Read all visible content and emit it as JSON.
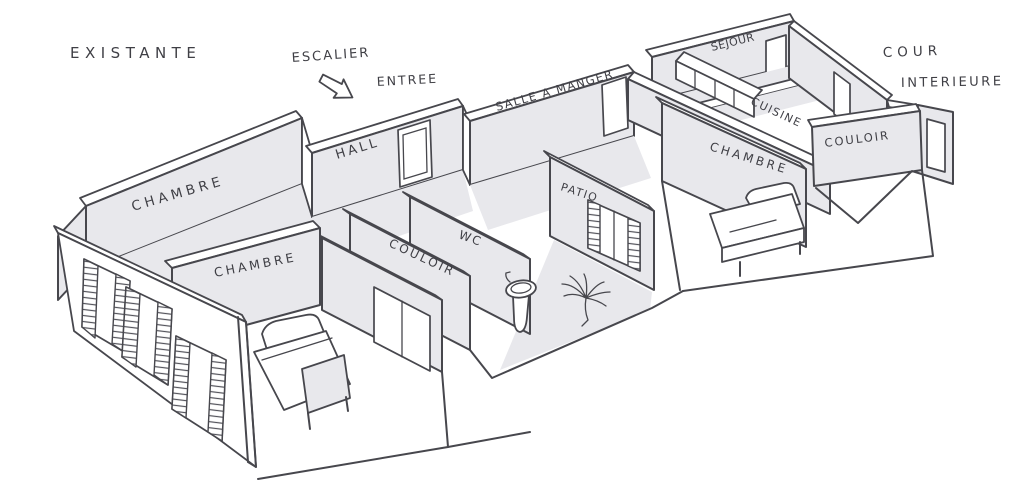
{
  "scene": {
    "kind": "hand-drawn axonometric floor plan sketch",
    "colors": {
      "paper": "#ffffff",
      "ink": "#47474d",
      "wall_fill": "#e8e8ec"
    },
    "entry_arrow_icon": "entry-direction-arrow"
  },
  "rooms_visible": [
    "CHAMBRE",
    "CHAMBRE",
    "CHAMBRE",
    "HALL",
    "SALLE A MANGER",
    "SEJOUR",
    "CUISINE",
    "COULOIR",
    "COULOIR",
    "WC",
    "PATIO"
  ],
  "annotations_visible": [
    "EXISTANTE",
    "ESCALIER",
    "ENTREE",
    "COUR INTERIEURE"
  ],
  "labels": [
    {
      "id": "existante-note",
      "text": "EXISTANTE",
      "x": 70,
      "y": 58,
      "rot": 0,
      "size": 15,
      "ls": 5.5
    },
    {
      "id": "escalier-note",
      "text": "ESCALIER",
      "x": 292,
      "y": 62,
      "rot": -4,
      "size": 13,
      "ls": 2
    },
    {
      "id": "entree-note",
      "text": "ENTREE",
      "x": 377,
      "y": 86,
      "rot": -3,
      "size": 12.5,
      "ls": 2
    },
    {
      "id": "salle-a-manger",
      "text": "SALLE A MANGER",
      "x": 497,
      "y": 111,
      "rot": -16,
      "size": 11.5,
      "ls": 1.5
    },
    {
      "id": "sejour",
      "text": "SEJOUR",
      "x": 712,
      "y": 51,
      "rot": -14,
      "size": 11,
      "ls": 0.5
    },
    {
      "id": "cour-note",
      "text": "COUR",
      "x": 883,
      "y": 57,
      "rot": -2,
      "size": 13.5,
      "ls": 5
    },
    {
      "id": "interieure-note",
      "text": "INTERIEURE",
      "x": 901,
      "y": 87,
      "rot": -1,
      "size": 13,
      "ls": 2.5
    },
    {
      "id": "cuisine",
      "text": "CUISINE",
      "x": 750,
      "y": 104,
      "rot": 25,
      "size": 11,
      "ls": 1.5
    },
    {
      "id": "hall",
      "text": "HALL",
      "x": 337,
      "y": 159,
      "rot": -17,
      "size": 13,
      "ls": 3
    },
    {
      "id": "chambre-back-left",
      "text": "CHAMBRE",
      "x": 133,
      "y": 211,
      "rot": -16,
      "size": 13.5,
      "ls": 4
    },
    {
      "id": "chambre-left",
      "text": "CHAMBRE",
      "x": 215,
      "y": 277,
      "rot": -11,
      "size": 12.5,
      "ls": 3
    },
    {
      "id": "couloir-center",
      "text": "COULOIR",
      "x": 388,
      "y": 246,
      "rot": 25,
      "size": 12,
      "ls": 2.5
    },
    {
      "id": "wc",
      "text": "WC",
      "x": 458,
      "y": 238,
      "rot": 20,
      "size": 12,
      "ls": 2
    },
    {
      "id": "patio",
      "text": "PATIO",
      "x": 560,
      "y": 190,
      "rot": 18,
      "size": 11,
      "ls": 1.5
    },
    {
      "id": "chambre-right",
      "text": "CHAMBRE",
      "x": 709,
      "y": 150,
      "rot": 17,
      "size": 12,
      "ls": 3
    },
    {
      "id": "couloir-right",
      "text": "COULOIR",
      "x": 825,
      "y": 147,
      "rot": -7,
      "size": 11.5,
      "ls": 2
    }
  ]
}
